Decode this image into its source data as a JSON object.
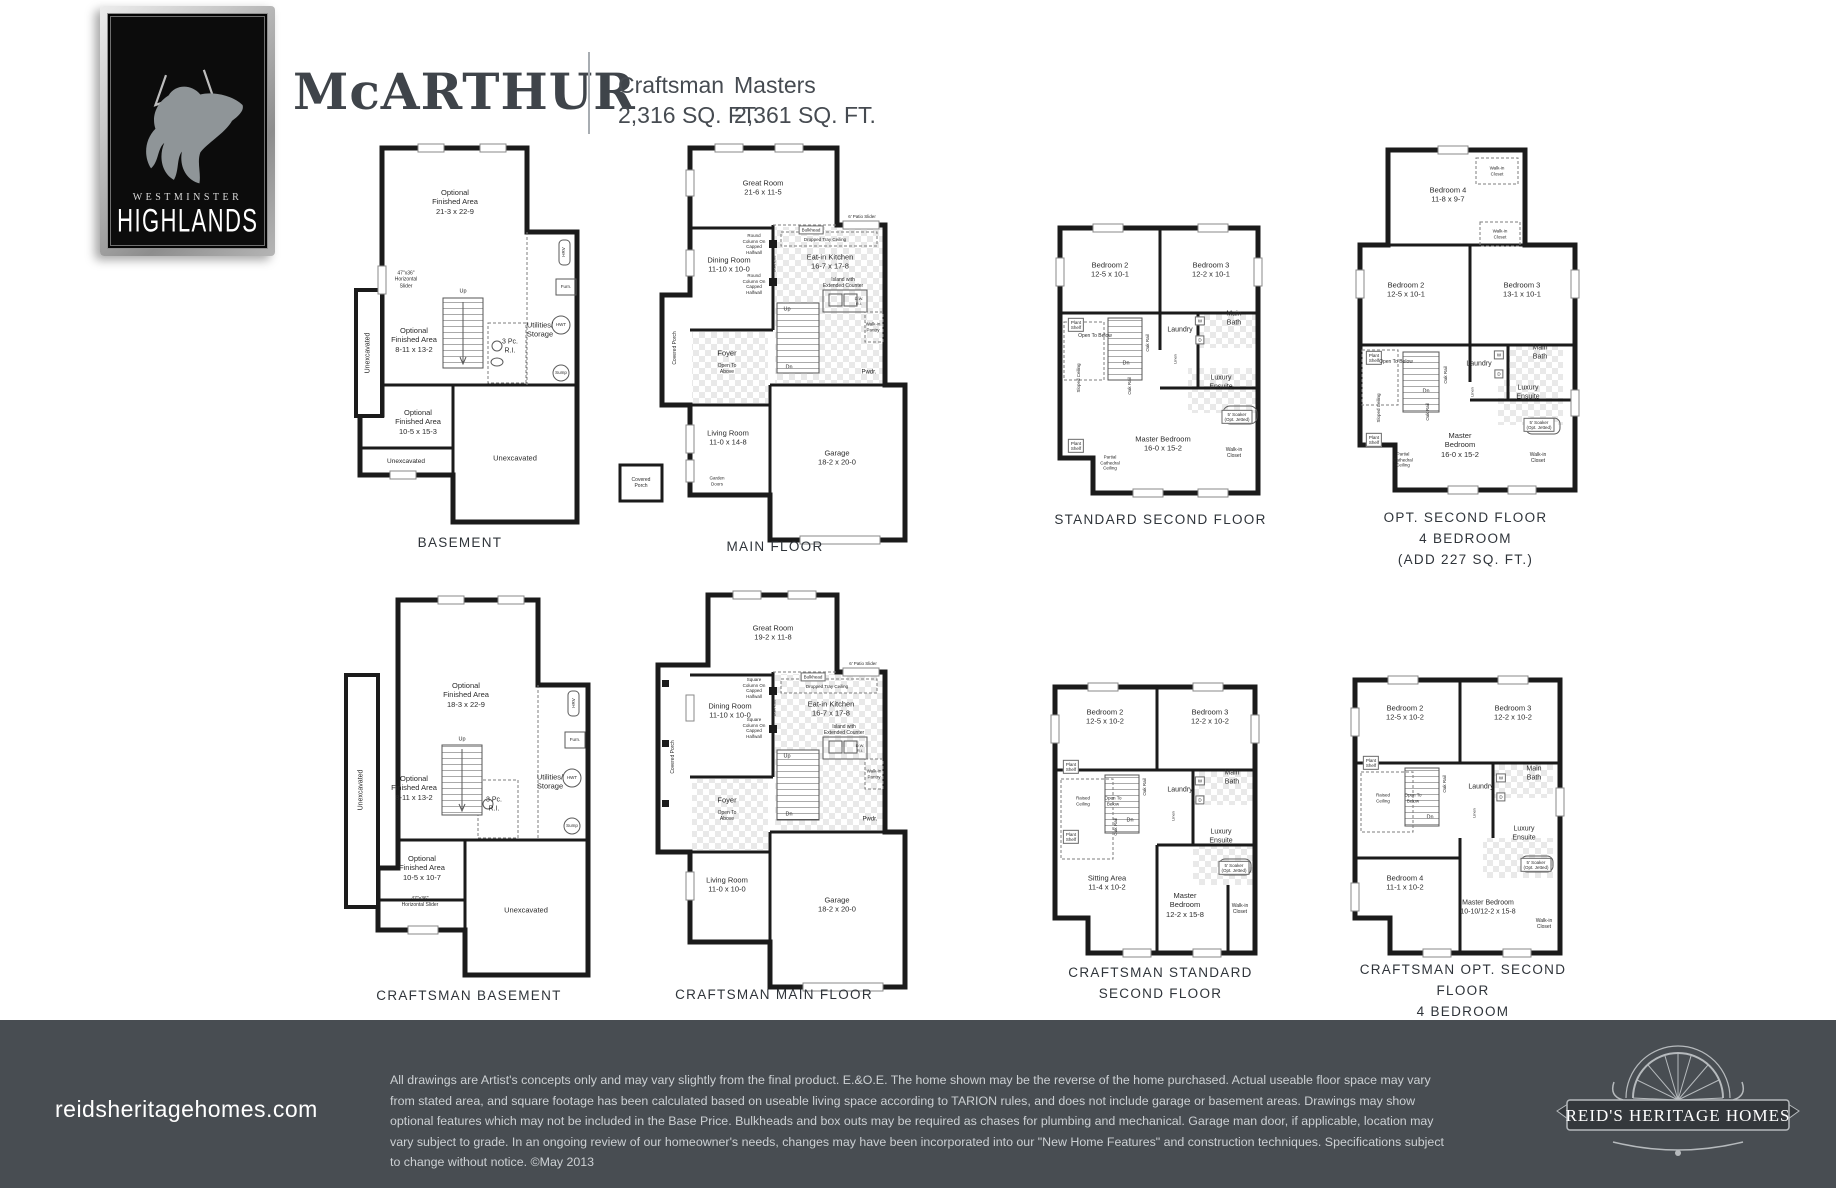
{
  "logo": {
    "line1": "WESTMINSTER",
    "line2": "HIGHLANDS"
  },
  "header": {
    "title": "McARTHUR",
    "variants": [
      {
        "name": "Craftsman",
        "sqft": "2,316 SQ. FT."
      },
      {
        "name": "Masters",
        "sqft": "2,361 SQ. FT."
      }
    ]
  },
  "plans": {
    "basement": {
      "caption": "BASEMENT",
      "labels": [
        {
          "t": "Optional\nFinished Area\n21-3 x 22-9",
          "x": 125,
          "y": 62
        },
        {
          "t": "47\"x36\"\nHorizontal\nSlider",
          "x": 76,
          "y": 140,
          "fs": 5,
          "n": "window-label"
        },
        {
          "t": "Unexcavated",
          "x": 39,
          "y": 213,
          "fs": 7,
          "r": -90
        },
        {
          "t": "Optional\nFinished Area\n8-11 x 13-2",
          "x": 84,
          "y": 200
        },
        {
          "t": "Up",
          "x": 133,
          "y": 152,
          "fs": 5.5
        },
        {
          "t": "3 Pc.\nR.I.",
          "x": 180,
          "y": 207,
          "fs": 7
        },
        {
          "t": "Utilities/\nStorage",
          "x": 210,
          "y": 190
        },
        {
          "t": "HRV",
          "x": 234,
          "y": 112,
          "fs": 4.5,
          "r": -90,
          "n": "hrv-icon"
        },
        {
          "t": "Furn.",
          "x": 236,
          "y": 147,
          "fs": 4.5,
          "n": "furnace-icon"
        },
        {
          "t": "HWT",
          "x": 231,
          "y": 185,
          "fs": 4.5,
          "n": "hwt-icon"
        },
        {
          "t": "Sump",
          "x": 231,
          "y": 233,
          "fs": 4.5,
          "n": "sump-icon"
        },
        {
          "t": "Optional\nFinished Area\n10-5 x 15-3",
          "x": 88,
          "y": 282
        },
        {
          "t": "Unexcavated",
          "x": 76,
          "y": 322,
          "fs": 6.5
        },
        {
          "t": "Unexcavated",
          "x": 185,
          "y": 318
        }
      ]
    },
    "main_floor": {
      "caption": "MAIN FLOOR",
      "labels": [
        {
          "t": "Great Room\n21-6 x 11-5",
          "x": 148,
          "y": 48
        },
        {
          "t": "Round\nColumn On\nCapped\nHalfwall",
          "x": 139,
          "y": 104,
          "fs": 4.5
        },
        {
          "t": "Round\nColumn On\nCapped\nHalfwall",
          "x": 139,
          "y": 144,
          "fs": 4.5
        },
        {
          "t": "Bulkhead",
          "x": 159,
          "y": 124,
          "fs": 4,
          "r": -90
        },
        {
          "t": "Bulkhead",
          "x": 196,
          "y": 90,
          "fs": 4.5,
          "b": 1
        },
        {
          "t": "Dropped Tray Ceiling",
          "x": 210,
          "y": 100,
          "fs": 4.5
        },
        {
          "t": "6' Patio Slider",
          "x": 247,
          "y": 77,
          "fs": 4.5
        },
        {
          "t": "Dining Room\n11-10 x 10-0",
          "x": 114,
          "y": 125
        },
        {
          "t": "Eat-in Kitchen\n16-7 x 17-8",
          "x": 215,
          "y": 122
        },
        {
          "t": "Island with\nExtended Counter",
          "x": 228,
          "y": 143,
          "fs": 5
        },
        {
          "t": "D.W.\nR.I.",
          "x": 244,
          "y": 161,
          "fs": 4
        },
        {
          "t": "Walk-in\nPantry",
          "x": 258,
          "y": 187,
          "fs": 4.5
        },
        {
          "t": "Foyer",
          "x": 112,
          "y": 213
        },
        {
          "t": "Open To\nAbove",
          "x": 112,
          "y": 229,
          "fs": 5
        },
        {
          "t": "Up",
          "x": 172,
          "y": 170,
          "fs": 5.5
        },
        {
          "t": "Dn",
          "x": 174,
          "y": 228,
          "fs": 5.5
        },
        {
          "t": "Pwdr.",
          "x": 254,
          "y": 233,
          "fs": 6
        },
        {
          "t": "Covered Porch",
          "x": 60,
          "y": 208,
          "fs": 5,
          "r": -90
        },
        {
          "t": "Living Room\n11-0 x 14-8",
          "x": 113,
          "y": 298
        },
        {
          "t": "Garden\nDoors",
          "x": 102,
          "y": 341,
          "fs": 4.5
        },
        {
          "t": "Garage\n18-2 x 20-0",
          "x": 222,
          "y": 318
        },
        {
          "t": "Covered\nPorch",
          "x": 26,
          "y": 343,
          "fs": 5
        }
      ]
    },
    "standard_second": {
      "caption": "STANDARD SECOND FLOOR",
      "labels": [
        {
          "t": "Bedroom 2\n12-5 x 10-1",
          "x": 62,
          "y": 52
        },
        {
          "t": "Bedroom 3\n12-2 x 10-1",
          "x": 163,
          "y": 52
        },
        {
          "t": "Plant\nShelf",
          "x": 28,
          "y": 107,
          "fs": 4.5,
          "b": 1
        },
        {
          "t": "Plant\nShelf",
          "x": 28,
          "y": 228,
          "fs": 4.5,
          "b": 1
        },
        {
          "t": "Open To Below",
          "x": 47,
          "y": 118,
          "fs": 5
        },
        {
          "t": "Sloped Ceiling",
          "x": 31,
          "y": 160,
          "fs": 4.5,
          "r": -90
        },
        {
          "t": "Oak Rail",
          "x": 100,
          "y": 125,
          "fs": 4.5,
          "r": -90
        },
        {
          "t": "Oak Rail",
          "x": 82,
          "y": 168,
          "fs": 4.5,
          "r": -90
        },
        {
          "t": "Dn",
          "x": 78,
          "y": 146,
          "fs": 5.5
        },
        {
          "t": "Laundry",
          "x": 132,
          "y": 113,
          "fs": 7
        },
        {
          "t": "W",
          "x": 152,
          "y": 103,
          "fs": 4.5,
          "b": 1
        },
        {
          "t": "D",
          "x": 152,
          "y": 122,
          "fs": 4.5,
          "b": 1
        },
        {
          "t": "Main\nBath",
          "x": 186,
          "y": 101,
          "fs": 7
        },
        {
          "t": "Linen",
          "x": 127,
          "y": 141,
          "fs": 4,
          "r": -90
        },
        {
          "t": "Luxury\nEnsuite",
          "x": 173,
          "y": 165,
          "fs": 7
        },
        {
          "t": "5' Soaker\n(Opt. Jetted)",
          "x": 189,
          "y": 199,
          "fs": 4.5,
          "b": 1
        },
        {
          "t": "Walk-in\nCloset",
          "x": 186,
          "y": 235,
          "fs": 5
        },
        {
          "t": "Master Bedroom\n16-0 x 15-2",
          "x": 115,
          "y": 226
        },
        {
          "t": "Partial\nCathedral\nCeiling",
          "x": 62,
          "y": 245,
          "fs": 4.5
        }
      ]
    },
    "opt_second": {
      "caption": "OPT. SECOND FLOOR\n4 BEDROOM\n(ADD 227 SQ. FT.)",
      "labels": [
        {
          "t": "Bedroom 4\n11-8 x 9-7",
          "x": 100,
          "y": 55
        },
        {
          "t": "Walk-in\nCloset",
          "x": 149,
          "y": 31,
          "fs": 4.5
        },
        {
          "t": "Walk-in\nCloset",
          "x": 152,
          "y": 94,
          "fs": 4.5
        },
        {
          "t": "Bedroom 2\n12-5 x 10-1",
          "x": 58,
          "y": 150
        },
        {
          "t": "Bedroom 3\n13-1 x 10-1",
          "x": 174,
          "y": 150
        },
        {
          "t": "Plant\nShelf",
          "x": 26,
          "y": 218,
          "fs": 4.5,
          "b": 1
        },
        {
          "t": "Plant\nShelf",
          "x": 26,
          "y": 300,
          "fs": 4.5,
          "b": 1
        },
        {
          "t": "Open To Below",
          "x": 48,
          "y": 222,
          "fs": 5
        },
        {
          "t": "Sloped Ceiling",
          "x": 31,
          "y": 268,
          "fs": 4.5,
          "r": -90
        },
        {
          "t": "Oak Rail",
          "x": 98,
          "y": 235,
          "fs": 4.5,
          "r": -90
        },
        {
          "t": "Oak Rail",
          "x": 80,
          "y": 272,
          "fs": 4.5,
          "r": -90
        },
        {
          "t": "Dn",
          "x": 78,
          "y": 252,
          "fs": 5.5
        },
        {
          "t": "Laundry",
          "x": 131,
          "y": 225,
          "fs": 7
        },
        {
          "t": "W",
          "x": 151,
          "y": 215,
          "fs": 4.5,
          "b": 1
        },
        {
          "t": "D",
          "x": 151,
          "y": 234,
          "fs": 4.5,
          "b": 1
        },
        {
          "t": "Main\nBath",
          "x": 192,
          "y": 213,
          "fs": 7
        },
        {
          "t": "Linen",
          "x": 124,
          "y": 252,
          "fs": 4,
          "r": -90
        },
        {
          "t": "Luxury\nEnsuite",
          "x": 180,
          "y": 253,
          "fs": 7
        },
        {
          "t": "5' Soaker\n(Opt. Jetted)",
          "x": 191,
          "y": 285,
          "fs": 4.5,
          "b": 1
        },
        {
          "t": "Walk-in\nCloset",
          "x": 190,
          "y": 318,
          "fs": 5
        },
        {
          "t": "Master\nBedroom\n16-0 x 15-2",
          "x": 112,
          "y": 305
        },
        {
          "t": "Partial\nCathedral\nCeiling",
          "x": 55,
          "y": 320,
          "fs": 4.5
        }
      ]
    },
    "craftsman_basement": {
      "caption": "CRAFTSMAN BASEMENT",
      "labels": [
        {
          "t": "Optional\nFinished Area\n18-3 x 22-9",
          "x": 128,
          "y": 105
        },
        {
          "t": "Unexcavated",
          "x": 24,
          "y": 200,
          "fs": 7,
          "r": -90
        },
        {
          "t": "Optional\nFinished Area\n8-11 x 13-2",
          "x": 76,
          "y": 198
        },
        {
          "t": "Up",
          "x": 124,
          "y": 150,
          "fs": 5.5
        },
        {
          "t": "3 Pc.\nR.I.",
          "x": 156,
          "y": 215,
          "fs": 7
        },
        {
          "t": "Utilities/\nStorage",
          "x": 212,
          "y": 192
        },
        {
          "t": "HRV",
          "x": 236,
          "y": 113,
          "fs": 4.5,
          "r": -90,
          "n": "hrv-icon"
        },
        {
          "t": "Furn.",
          "x": 237,
          "y": 150,
          "fs": 4.5,
          "n": "furnace-icon"
        },
        {
          "t": "HWT",
          "x": 234,
          "y": 188,
          "fs": 4.5,
          "n": "hwt-icon"
        },
        {
          "t": "Sump",
          "x": 234,
          "y": 236,
          "fs": 4.5,
          "n": "sump-icon"
        },
        {
          "t": "Optional\nFinished Area\n10-5 x 10-7",
          "x": 84,
          "y": 278
        },
        {
          "t": "47\"x36\"\nHorizontal Slider",
          "x": 82,
          "y": 312,
          "fs": 5,
          "n": "window-label"
        },
        {
          "t": "Unexcavated",
          "x": 188,
          "y": 320
        }
      ]
    },
    "craftsman_main": {
      "caption": "CRAFTSMAN MAIN FLOOR",
      "labels": [
        {
          "t": "Great Room\n19-2 x 11-8",
          "x": 160,
          "y": 48
        },
        {
          "t": "Square\nColumn On\nCapped\nHalfwall",
          "x": 141,
          "y": 103,
          "fs": 4.5
        },
        {
          "t": "Square\nColumn On\nCapped\nHalfwall",
          "x": 141,
          "y": 143,
          "fs": 4.5
        },
        {
          "t": "Bulkhead",
          "x": 161,
          "y": 123,
          "fs": 4,
          "r": -90
        },
        {
          "t": "Bulkhead",
          "x": 200,
          "y": 92,
          "fs": 4.5,
          "b": 1
        },
        {
          "t": "Dropped Tray Ceiling",
          "x": 214,
          "y": 102,
          "fs": 4.5
        },
        {
          "t": "6' Patio Slider",
          "x": 250,
          "y": 79,
          "fs": 4.5
        },
        {
          "t": "Dining Room\n11-10 x 10-0",
          "x": 117,
          "y": 126
        },
        {
          "t": "Eat-in Kitchen\n16-7 x 17-8",
          "x": 218,
          "y": 124
        },
        {
          "t": "Island with\nExtended Counter",
          "x": 231,
          "y": 145,
          "fs": 5
        },
        {
          "t": "D.W.\nR.I.",
          "x": 247,
          "y": 163,
          "fs": 4
        },
        {
          "t": "Walk-in\nPantry",
          "x": 261,
          "y": 189,
          "fs": 4.5
        },
        {
          "t": "Foyer",
          "x": 114,
          "y": 215
        },
        {
          "t": "Open To\nAbove",
          "x": 114,
          "y": 231,
          "fs": 5
        },
        {
          "t": "Up",
          "x": 174,
          "y": 172,
          "fs": 5.5
        },
        {
          "t": "Dn",
          "x": 176,
          "y": 230,
          "fs": 5.5
        },
        {
          "t": "Pwdr.",
          "x": 257,
          "y": 235,
          "fs": 6
        },
        {
          "t": "Covered Porch",
          "x": 60,
          "y": 172,
          "fs": 5,
          "r": -90
        },
        {
          "t": "Living Room\n11-0 x 10-0",
          "x": 114,
          "y": 300
        },
        {
          "t": "Garage\n18-2 x 20-0",
          "x": 224,
          "y": 320
        }
      ]
    },
    "craftsman_standard_second": {
      "caption": "CRAFTSMAN STANDARD SECOND FLOOR",
      "labels": [
        {
          "t": "Bedroom 2\n12-5 x 10-2",
          "x": 62,
          "y": 42
        },
        {
          "t": "Bedroom 3\n12-2 x 10-2",
          "x": 167,
          "y": 42
        },
        {
          "t": "Plant\nShelf",
          "x": 28,
          "y": 92,
          "fs": 4.5,
          "b": 1
        },
        {
          "t": "Plant\nShelf",
          "x": 28,
          "y": 162,
          "fs": 4.5,
          "b": 1
        },
        {
          "t": "Raised\nCeiling",
          "x": 40,
          "y": 126,
          "fs": 4.5
        },
        {
          "t": "Open To\nBelow",
          "x": 70,
          "y": 126,
          "fs": 4.5
        },
        {
          "t": "Oak Rail",
          "x": 102,
          "y": 112,
          "fs": 4.5,
          "r": -90
        },
        {
          "t": "Oak Rail",
          "x": 73,
          "y": 152,
          "fs": 4.5,
          "r": -90
        },
        {
          "t": "Dn",
          "x": 87,
          "y": 146,
          "fs": 5.5
        },
        {
          "t": "Laundry",
          "x": 137,
          "y": 116,
          "fs": 7
        },
        {
          "t": "W",
          "x": 157,
          "y": 106,
          "fs": 4.5,
          "b": 1
        },
        {
          "t": "D",
          "x": 157,
          "y": 125,
          "fs": 4.5,
          "b": 1
        },
        {
          "t": "Main\nBath",
          "x": 189,
          "y": 103,
          "fs": 7
        },
        {
          "t": "Linen",
          "x": 130,
          "y": 141,
          "fs": 4,
          "r": -90
        },
        {
          "t": "Luxury\nEnsuite",
          "x": 178,
          "y": 162,
          "fs": 7
        },
        {
          "t": "5' Soaker\n(Opt. Jetted)",
          "x": 191,
          "y": 193,
          "fs": 4.5,
          "b": 1
        },
        {
          "t": "Sitting Area\n11-4 x 10-2",
          "x": 64,
          "y": 208
        },
        {
          "t": "Master\nBedroom\n12-2 x 15-8",
          "x": 142,
          "y": 230
        },
        {
          "t": "Walk-in\nCloset",
          "x": 197,
          "y": 234,
          "fs": 5
        }
      ]
    },
    "craftsman_opt_second": {
      "caption": "CRAFTSMAN OPT. SECOND FLOOR\n4 BEDROOM",
      "labels": [
        {
          "t": "Bedroom 2\n12-5 x 10-2",
          "x": 62,
          "y": 45
        },
        {
          "t": "Bedroom 3\n12-2 x 10-2",
          "x": 170,
          "y": 45
        },
        {
          "t": "Plant\nShelf",
          "x": 28,
          "y": 95,
          "fs": 4.5,
          "b": 1
        },
        {
          "t": "Raised\nCeiling",
          "x": 40,
          "y": 130,
          "fs": 4.5
        },
        {
          "t": "Open To\nBelow",
          "x": 70,
          "y": 130,
          "fs": 4.5
        },
        {
          "t": "Oak Rail",
          "x": 102,
          "y": 116,
          "fs": 4.5,
          "r": -90
        },
        {
          "t": "Dn",
          "x": 87,
          "y": 150,
          "fs": 5.5
        },
        {
          "t": "Laundry",
          "x": 138,
          "y": 120,
          "fs": 7
        },
        {
          "t": "W",
          "x": 158,
          "y": 110,
          "fs": 4.5,
          "b": 1
        },
        {
          "t": "D",
          "x": 158,
          "y": 129,
          "fs": 4.5,
          "b": 1
        },
        {
          "t": "Main\nBath",
          "x": 191,
          "y": 106,
          "fs": 7
        },
        {
          "t": "Linen",
          "x": 131,
          "y": 145,
          "fs": 4,
          "r": -90
        },
        {
          "t": "Luxury\nEnsuite",
          "x": 181,
          "y": 166,
          "fs": 7
        },
        {
          "t": "5' Soaker\n(Opt. Jetted)",
          "x": 193,
          "y": 197,
          "fs": 4.5,
          "b": 1
        },
        {
          "t": "Bedroom 4\n11-1 x 10-2",
          "x": 62,
          "y": 215
        },
        {
          "t": "Master Bedroom\n10-10/12-2 x 15-8",
          "x": 145,
          "y": 240,
          "fs": 7
        },
        {
          "t": "Walk-in\nCloset",
          "x": 201,
          "y": 256,
          "fs": 5
        }
      ]
    }
  },
  "footer": {
    "website": "reidsheritagehomes.com",
    "disclaimer": "All drawings are Artist's concepts only and may vary slightly from the final product. E.&O.E. The home shown may be the reverse of the home purchased. Actual useable floor space may vary from stated area, and square footage has been calculated based on useable living space according to TARION rules, and does not include garage or basement areas. Drawings may show optional features which may not be included in the Base Price. Bulkheads and box outs may be required as chases for plumbing and mechanical. Garage man door, if applicable, location may vary subject to grade. In an ongoing review of our homeowner's needs, changes may have been incorporated into our \"New Home Features\" and construction techniques. Specifications subject to change without notice. ©May 2013",
    "brand": "REID'S HERITAGE HOMES"
  },
  "colors": {
    "footer_bg": "#484d52",
    "heading": "#3f444a",
    "wall": "#1b1b1b"
  }
}
